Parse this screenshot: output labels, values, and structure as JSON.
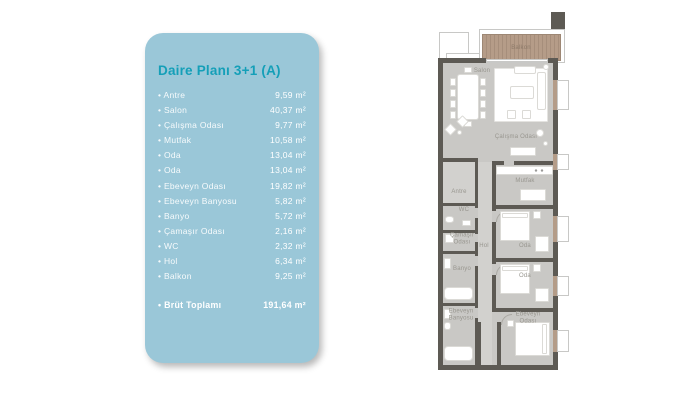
{
  "card": {
    "title": "Daire Planı 3+1 (A)",
    "bg_color": "#9ac7d8",
    "title_color": "#149fb8",
    "items": [
      {
        "name": "Antre",
        "area": "9,59 m²"
      },
      {
        "name": "Salon",
        "area": "40,37 m²"
      },
      {
        "name": "Çalışma Odası",
        "area": "9,77 m²"
      },
      {
        "name": "Mutfak",
        "area": "10,58 m²"
      },
      {
        "name": "Oda",
        "area": "13,04 m²"
      },
      {
        "name": "Oda",
        "area": "13,04 m²"
      },
      {
        "name": "Ebeveyn Odası",
        "area": "19,82 m²"
      },
      {
        "name": "Ebeveyn Banyosu",
        "area": "5,82 m²"
      },
      {
        "name": "Banyo",
        "area": "5,72 m²"
      },
      {
        "name": "Çamaşır Odası",
        "area": "2,16 m²"
      },
      {
        "name": "WC",
        "area": "2,32 m²"
      },
      {
        "name": "Hol",
        "area": "6,34 m²"
      },
      {
        "name": "Balkon",
        "area": "9,25 m²"
      }
    ],
    "total": {
      "name": "Brüt Toplamı",
      "area": "191,64 m²"
    }
  },
  "floor_plan": {
    "labels": {
      "balkon": "Balkon",
      "salon": "Salon",
      "calisma_odasi": "Çalışma Odası",
      "mutfak": "Mutfak",
      "antre": "Antre",
      "wc": "WC",
      "camasir_odasi": "Çamaşır Odası",
      "hol": "Hol",
      "oda_1": "Oda",
      "oda_2": "Oda",
      "banyo": "Banyo",
      "ebeveyn_banyosu": "Ebeveyn Banyosu",
      "ebeveyn_odasi": "Ebeveyn Odası"
    },
    "colors": {
      "wall": "#5d5a54",
      "floor": "#c9c8c5",
      "wood": "#b59c88",
      "label_text": "#98968f"
    }
  }
}
